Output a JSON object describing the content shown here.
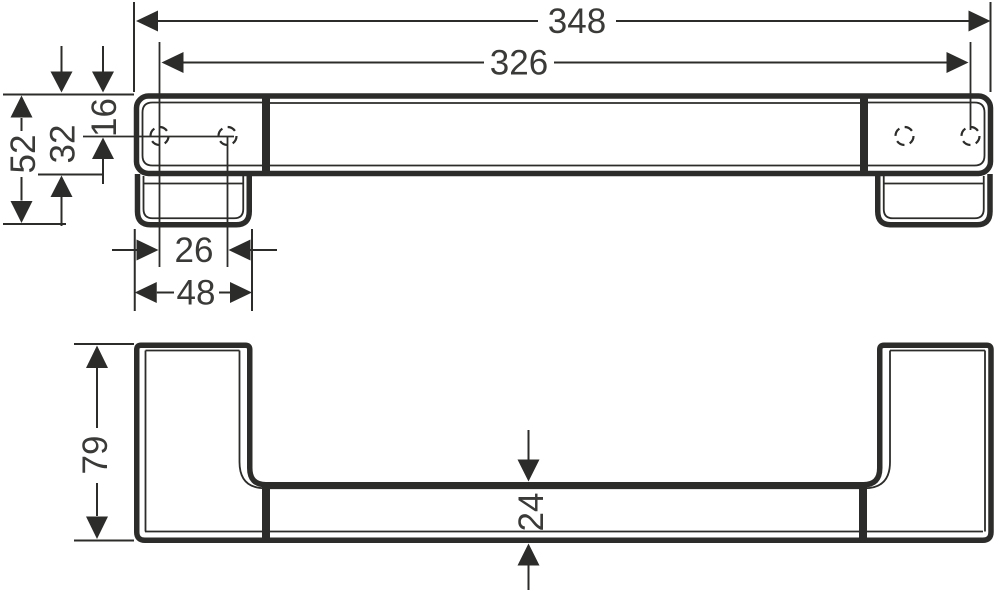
{
  "drawing": {
    "type": "technical-dimension-drawing",
    "background": "#ffffff",
    "line_color": "#2c2c2a",
    "text_color": "#3a3a38",
    "dimensions": {
      "overall_length": "348",
      "fixing_hole_distance": "326",
      "end_height": "52",
      "profile_height": "32",
      "hole_offset_from_top": "16",
      "hole_pitch": "26",
      "end_plate_width": "48",
      "overall_depth": "79",
      "profile_depth": "24"
    }
  }
}
